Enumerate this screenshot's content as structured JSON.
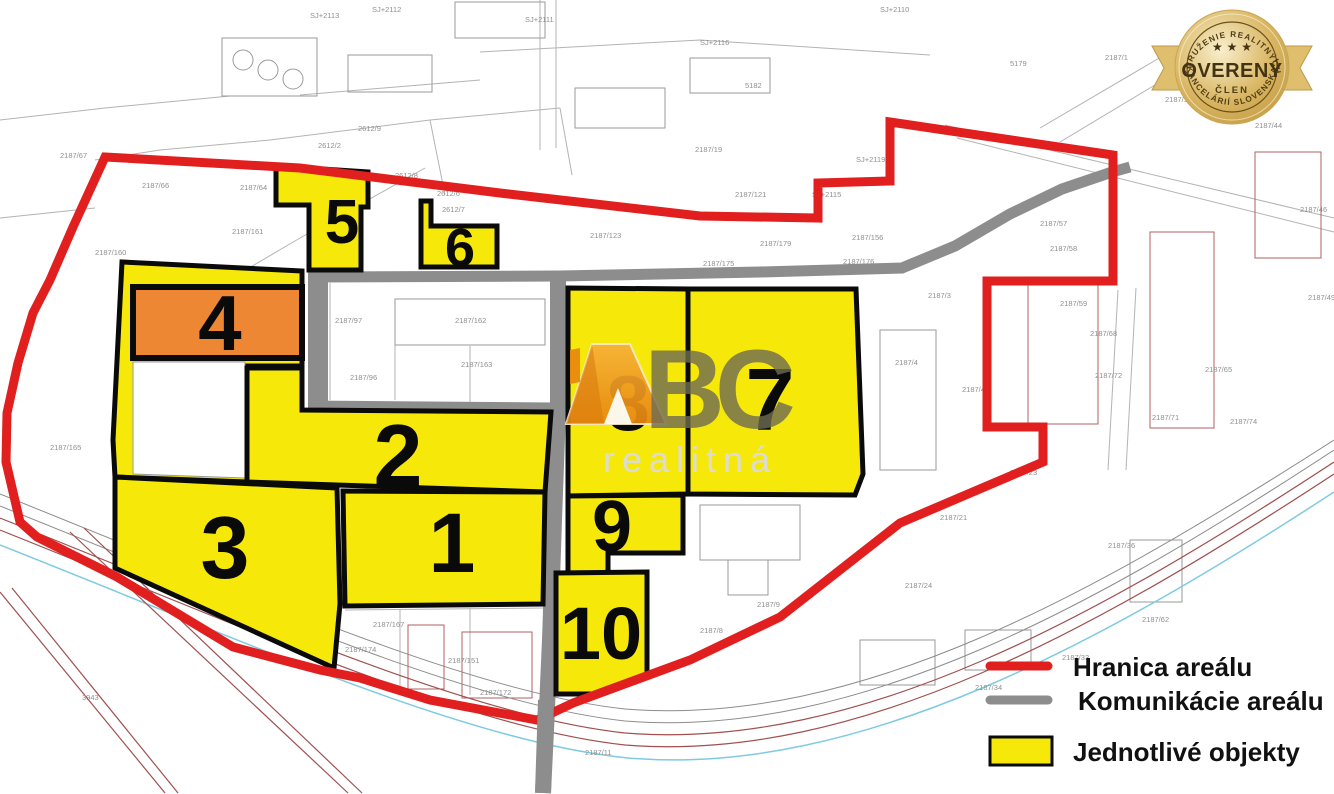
{
  "map": {
    "colors": {
      "boundary": "#e11f1f",
      "road": "#8d8d8d",
      "parcel_fill": "#f6e90a",
      "highlight_parcel_fill": "#ee8733",
      "parcel_border": "#0a0a0a",
      "badge_gold": "#d9b663",
      "logo_orange": "#ef9a1d"
    },
    "parcels": [
      {
        "number": "1"
      },
      {
        "number": "2"
      },
      {
        "number": "3"
      },
      {
        "number": "4"
      },
      {
        "number": "5"
      },
      {
        "number": "6"
      },
      {
        "number": "7"
      },
      {
        "number": "8"
      },
      {
        "number": "9"
      },
      {
        "number": "10"
      }
    ],
    "legend": {
      "items": [
        {
          "label": "Hranica areálu",
          "swatch": "line",
          "color": "#e11f1f"
        },
        {
          "label": "Komunikácie areálu",
          "swatch": "line",
          "color": "#8d8d8d"
        },
        {
          "label": "Jednotlivé objekty",
          "swatch": "box",
          "color": "#f6e90a"
        }
      ]
    },
    "badge": {
      "arc_top": "ZDRUŽENIE REALITNÝCH",
      "stars": "★ ★ ★",
      "title": "OVERENÝ",
      "subtitle": "ČLEN",
      "arc_bottom": "KANCELÁRIÍ SLOVENSKA"
    },
    "logo": {
      "bc": "BC",
      "tagline": "realitná"
    },
    "background_labels": [
      {
        "x": 60,
        "y": 158,
        "t": "2187/67"
      },
      {
        "x": 142,
        "y": 188,
        "t": "2187/66"
      },
      {
        "x": 240,
        "y": 190,
        "t": "2187/64"
      },
      {
        "x": 232,
        "y": 234,
        "t": "2187/161"
      },
      {
        "x": 95,
        "y": 255,
        "t": "2187/160"
      },
      {
        "x": 318,
        "y": 148,
        "t": "2612/2"
      },
      {
        "x": 358,
        "y": 131,
        "t": "2612/9"
      },
      {
        "x": 437,
        "y": 196,
        "t": "2612/6"
      },
      {
        "x": 442,
        "y": 212,
        "t": "2612/7"
      },
      {
        "x": 395,
        "y": 178,
        "t": "2612/8"
      },
      {
        "x": 335,
        "y": 323,
        "t": "2187/97"
      },
      {
        "x": 455,
        "y": 323,
        "t": "2187/162"
      },
      {
        "x": 461,
        "y": 367,
        "t": "2187/163"
      },
      {
        "x": 350,
        "y": 380,
        "t": "2187/96"
      },
      {
        "x": 168,
        "y": 366,
        "t": "2187/152"
      },
      {
        "x": 157,
        "y": 378,
        "t": "2187/127"
      },
      {
        "x": 187,
        "y": 403,
        "t": "2187/126"
      },
      {
        "x": 197,
        "y": 451,
        "t": "2187/77"
      },
      {
        "x": 50,
        "y": 450,
        "t": "2187/165"
      },
      {
        "x": 140,
        "y": 492,
        "t": "2187/168"
      },
      {
        "x": 152,
        "y": 520,
        "t": "2187/173"
      },
      {
        "x": 373,
        "y": 627,
        "t": "2187/167"
      },
      {
        "x": 345,
        "y": 652,
        "t": "2187/174"
      },
      {
        "x": 448,
        "y": 663,
        "t": "2187/151"
      },
      {
        "x": 480,
        "y": 695,
        "t": "2187/172"
      },
      {
        "x": 585,
        "y": 755,
        "t": "2187/11"
      },
      {
        "x": 590,
        "y": 238,
        "t": "2187/123"
      },
      {
        "x": 703,
        "y": 266,
        "t": "2187/175"
      },
      {
        "x": 843,
        "y": 264,
        "t": "2187/176"
      },
      {
        "x": 760,
        "y": 246,
        "t": "2187/179"
      },
      {
        "x": 735,
        "y": 197,
        "t": "2187/121"
      },
      {
        "x": 856,
        "y": 162,
        "t": "SJ+2119"
      },
      {
        "x": 812,
        "y": 197,
        "t": "SJ+2115"
      },
      {
        "x": 695,
        "y": 152,
        "t": "2187/19"
      },
      {
        "x": 852,
        "y": 240,
        "t": "2187/156"
      },
      {
        "x": 895,
        "y": 365,
        "t": "2187/4"
      },
      {
        "x": 962,
        "y": 392,
        "t": "2187/41"
      },
      {
        "x": 928,
        "y": 298,
        "t": "2187/3"
      },
      {
        "x": 1040,
        "y": 226,
        "t": "2187/57"
      },
      {
        "x": 1050,
        "y": 251,
        "t": "2187/58"
      },
      {
        "x": 1060,
        "y": 306,
        "t": "2187/59"
      },
      {
        "x": 1090,
        "y": 336,
        "t": "2187/68"
      },
      {
        "x": 1095,
        "y": 378,
        "t": "2187/72"
      },
      {
        "x": 1205,
        "y": 372,
        "t": "2187/65"
      },
      {
        "x": 1152,
        "y": 420,
        "t": "2187/71"
      },
      {
        "x": 1230,
        "y": 424,
        "t": "2187/74"
      },
      {
        "x": 310,
        "y": 18,
        "t": "SJ+2113"
      },
      {
        "x": 372,
        "y": 12,
        "t": "SJ+2112"
      },
      {
        "x": 525,
        "y": 22,
        "t": "SJ+2111"
      },
      {
        "x": 700,
        "y": 45,
        "t": "SJ+2116"
      },
      {
        "x": 745,
        "y": 88,
        "t": "5182"
      },
      {
        "x": 880,
        "y": 12,
        "t": "SJ+2110"
      },
      {
        "x": 1010,
        "y": 66,
        "t": "5179"
      },
      {
        "x": 1105,
        "y": 60,
        "t": "2187/1"
      },
      {
        "x": 1165,
        "y": 102,
        "t": "2187/164"
      },
      {
        "x": 1255,
        "y": 128,
        "t": "2187/44"
      },
      {
        "x": 1300,
        "y": 212,
        "t": "2187/46"
      },
      {
        "x": 1308,
        "y": 300,
        "t": "2187/49"
      },
      {
        "x": 1010,
        "y": 475,
        "t": "2187/23"
      },
      {
        "x": 940,
        "y": 520,
        "t": "2187/21"
      },
      {
        "x": 700,
        "y": 633,
        "t": "2187/8"
      },
      {
        "x": 757,
        "y": 607,
        "t": "2187/9"
      },
      {
        "x": 905,
        "y": 588,
        "t": "2187/24"
      },
      {
        "x": 1108,
        "y": 548,
        "t": "2187/36"
      },
      {
        "x": 1142,
        "y": 622,
        "t": "2187/62"
      },
      {
        "x": 1062,
        "y": 660,
        "t": "2187/33"
      },
      {
        "x": 975,
        "y": 690,
        "t": "2187/34"
      },
      {
        "x": 82,
        "y": 700,
        "t": "3943"
      }
    ]
  }
}
